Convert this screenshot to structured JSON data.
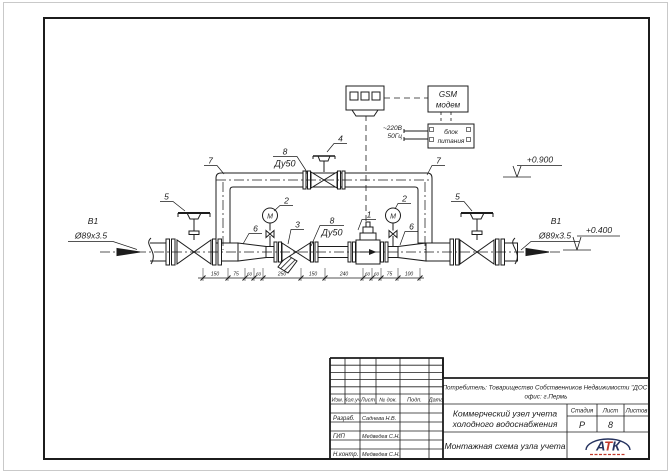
{
  "schematic": {
    "left_line": {
      "tag": "В1",
      "size": "Ø89x3.5"
    },
    "right_line": {
      "tag": "В1",
      "size": "Ø89x3.5"
    },
    "elevations": {
      "bypass": "+0.900",
      "main": "+0.400"
    },
    "labels": {
      "meter": "1",
      "gauge_left": "2",
      "gauge_right": "2",
      "filter": "3",
      "bypass_valve": "4",
      "valve_left": "5",
      "valve_right": "5",
      "reducer_left": "6",
      "reducer_right": "6",
      "elbow_left": "7",
      "elbow_right": "7",
      "pipe_top_num": "8",
      "pipe_top_dn": "Ду50",
      "pipe_mid_num": "8",
      "pipe_mid_dn": "Ду50"
    },
    "gauge_letter": "М",
    "gsm": {
      "line1": "GSM",
      "line2": "модем"
    },
    "psu": {
      "line1": "блок",
      "line2": "питания"
    },
    "power": {
      "voltage": "~220В",
      "freq": "50Гц"
    },
    "dims": [
      "150",
      "75",
      "60",
      "60",
      "250",
      "150",
      "240",
      "60",
      "60",
      "75",
      "100"
    ]
  },
  "title_block": {
    "customer_line1": "Потребитель: Товарищество Собственников Недвижимости \"ДОС\"",
    "customer_line2": "офис: г.Пермь",
    "project_line1": "Коммерческий узел учета",
    "project_line2": "холодного водоснабжения",
    "sheet_title": "Монтажная схема узла учета",
    "columns": {
      "izm": "Изм.",
      "kol": "Кол.уч",
      "list": "Лист",
      "doc": "№ док.",
      "podp": "Подп.",
      "data": "Дата"
    },
    "signature_rows": [
      {
        "role": "Разраб.",
        "name": "Саднева Н.В."
      },
      {
        "role": "ГИП",
        "name": "Медведев С.Н."
      },
      {
        "role": "Н.контр.",
        "name": "Медведев С.Н."
      }
    ],
    "stage_header": {
      "stage": "Стадия",
      "sheet": "Лист",
      "sheets": "Листов"
    },
    "stage_values": {
      "stage": "Р",
      "sheet": "8",
      "sheets": ""
    },
    "logo": {
      "a": "А",
      "t": "Т",
      "k": "К",
      "navy": "#26335f",
      "red": "#c0392b"
    }
  }
}
